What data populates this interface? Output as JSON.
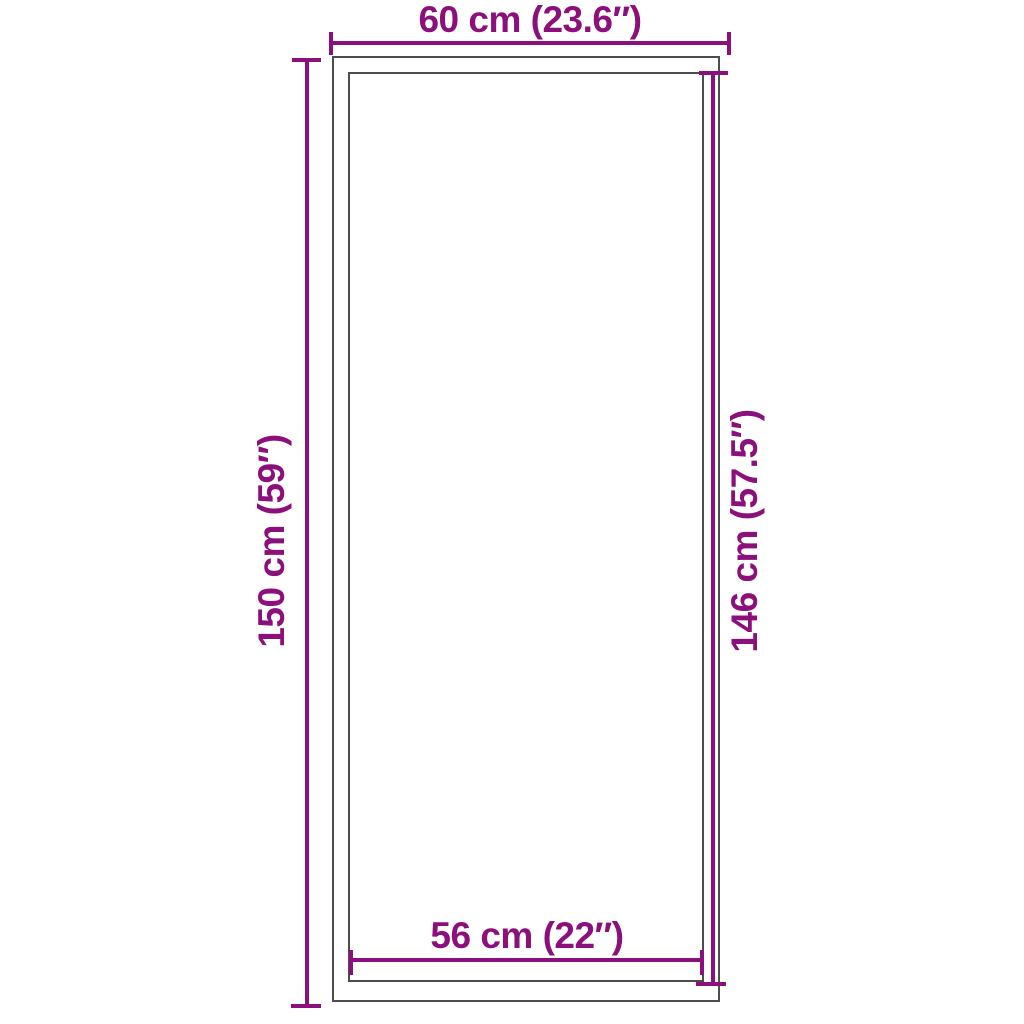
{
  "diagram": {
    "type": "product-dimension-diagram",
    "colors": {
      "accent": "#8B107C",
      "outline": "#4D4D4D",
      "background": "#FFFFFF"
    },
    "dimensions": {
      "top": {
        "label": "60 cm (23.6″)",
        "placement": "top-outside",
        "orientation": "horizontal"
      },
      "left": {
        "label": "150 cm (59″)",
        "placement": "left-outside",
        "orientation": "vertical"
      },
      "right": {
        "label": "146 cm (57.5″)",
        "placement": "right-inside",
        "orientation": "vertical"
      },
      "bottom": {
        "label": "56 cm (22″)",
        "placement": "bottom-inside",
        "orientation": "horizontal"
      }
    }
  }
}
